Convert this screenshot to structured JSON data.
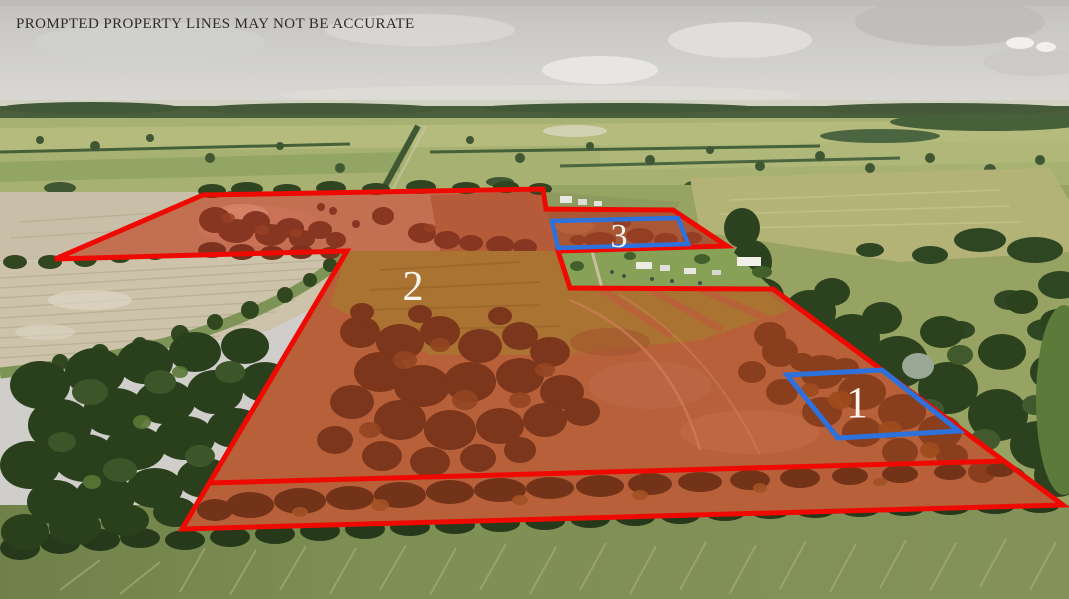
{
  "disclaimer": "PROMPTED PROPERTY LINES MAY NOT BE ACCURATE",
  "parcels": [
    {
      "id": "1",
      "label": "1",
      "outline_color": "#2d72dc"
    },
    {
      "id": "2",
      "label": "2",
      "outline_color": "#ee0a02"
    },
    {
      "id": "3",
      "label": "3",
      "outline_color": "#2d72dc"
    }
  ],
  "colors": {
    "boundary_red": "#ee0a02",
    "parcel_blue": "#2d72dc",
    "label_text": "#f7f4ed",
    "disclaimer_text": "#2e2c29"
  }
}
